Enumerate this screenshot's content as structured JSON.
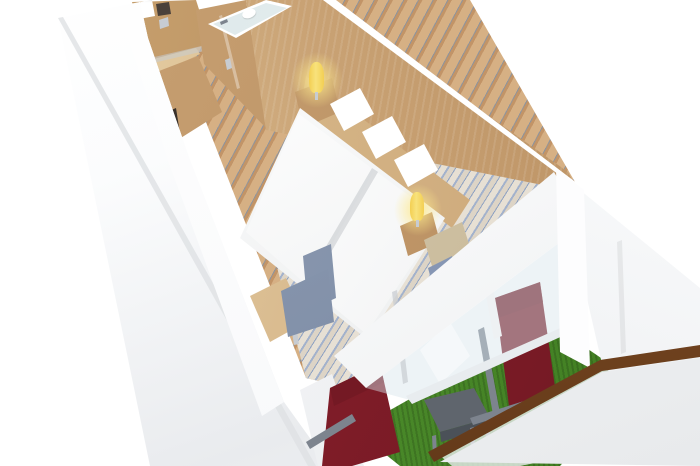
{
  "scene": {
    "title": "cruise-cabin-3d-cutaway-render",
    "view": "isometric overhead cutaway, cabin runs from entrance (top-left) to private balcony (bottom-right)",
    "background": "plain white",
    "areas": {
      "entry": [
        "cabin-door with notice-sign, card-reader and chrome handle",
        "wardrobe with minibar niche"
      ],
      "bathroom": [
        "wood-laminate cube with glass top edge",
        "toilet and shower visible from above",
        "glass door with chrome handle"
      ],
      "sleeping": [
        "two twin beds with white duvets",
        "three white pillows",
        "wood headboard panel",
        "two wooden nightstands",
        "two lit yellow lamps"
      ],
      "living": [
        "wooden desk with chrome leg",
        "blue-gray desk chair",
        "beige armchair with blue cushion",
        "patterned carpets (tan zigzag hallway, cream-blue wave seating area)"
      ],
      "balcony": [
        "green artificial turf",
        "two dark-red sling chairs with gray frames",
        "gray side table",
        "white partitions",
        "glass balustrade with wooden handrail",
        "white deck fascia"
      ]
    }
  },
  "colors": {
    "bg": "#ffffff",
    "wallA": "#fbfcfd",
    "wallB": "#e9ebee",
    "wallTop": "#f6f7f9",
    "wallEdge": "#dfe1e4",
    "woodA": "#e8d2a8",
    "woodB": "#c9a274",
    "woodC": "#b58a5c",
    "woodHead": "#dcc091",
    "doorWood": "#c9a371",
    "doorWoodB": "#b08352",
    "nicheDark": "#38302a",
    "carpetTanA": "#d6b084",
    "carpetTanB": "#c29467",
    "carpetThread": "#8f949c",
    "carpetCream": "#e7e0d4",
    "carpetCream2": "#ddd4c6",
    "carpetBlue": "#a3b2cc",
    "carpetBlue2": "#8fa2c2",
    "turfA": "#579934",
    "turfB": "#3f7c21",
    "glassTint": "rgba(216,229,234,0.45)",
    "glassBath": "#d7e4e6",
    "balGlass": "rgba(238,241,243,0.78)",
    "white": "#ffffff",
    "duvetA": "#ffffff",
    "duvetB": "#e7e9ea",
    "duvetShadow": "rgba(90,100,110,0.18)",
    "redA": "#93212f",
    "redB": "#6f1822",
    "grayTable": "#5f656d",
    "grayTableSide": "#4b5158",
    "frameGray": "#7d848e",
    "railA": "#8a5428",
    "railB": "#643a1a",
    "lampYellow": "#f3cf52",
    "lampGlow": "rgba(253,233,140,0.9)",
    "lampGlowOut": "rgba(253,233,140,0)",
    "blueChairA": "#93a1b8",
    "blueChairB": "#77869f",
    "beige": "#d8cbb0",
    "cushionBlue": "#92a2bd",
    "chrome": "#c7ccd2",
    "darkHardware": "#4a413a",
    "deckA": "#f7f8f9",
    "deckB": "#e8eaec"
  }
}
